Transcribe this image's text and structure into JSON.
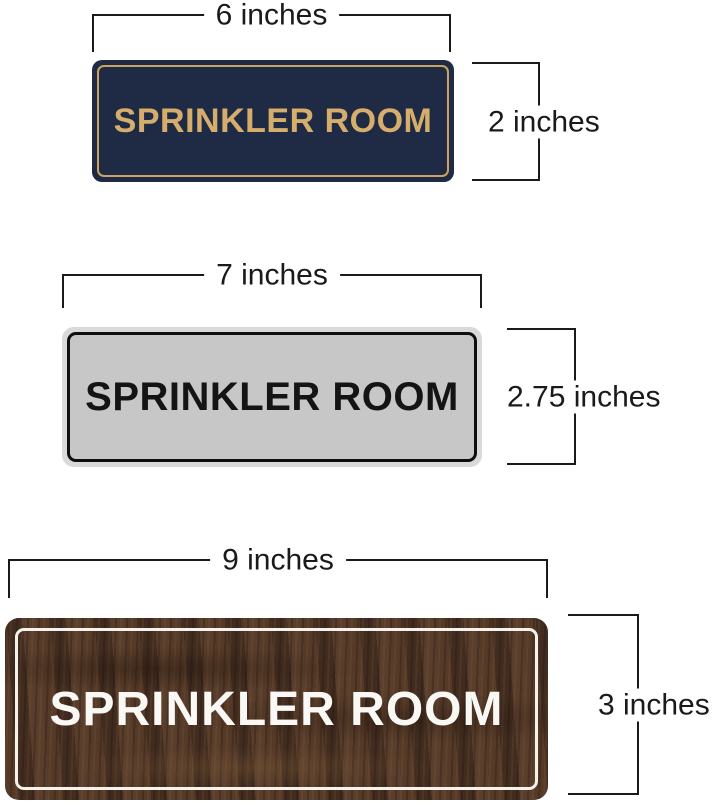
{
  "signs": [
    {
      "text": "SPRINKLER ROOM",
      "width_label": "6 inches",
      "height_label": "2 inches",
      "style": "navy plastic with gold frame",
      "bg_color": "#1f2b45",
      "border_color": "#cda261",
      "text_color": "#d7ad6b"
    },
    {
      "text": "SPRINKLER ROOM",
      "width_label": "7 inches",
      "height_label": "2.75 inches",
      "style": "brushed silver with black frame",
      "bg_color": "#c7c7c7",
      "rim_color": "#d9d9d9",
      "border_color": "#0e0e0e",
      "text_color": "#141414"
    },
    {
      "text": "SPRINKLER ROOM",
      "width_label": "9 inches",
      "height_label": "3 inches",
      "style": "walnut wood grain with white frame",
      "bg_color": "#4a3226",
      "border_color": "#f5f2ec",
      "text_color": "#faf8f4"
    }
  ],
  "dimension_line_color": "#1a1a1a",
  "background_color": "#ffffff"
}
